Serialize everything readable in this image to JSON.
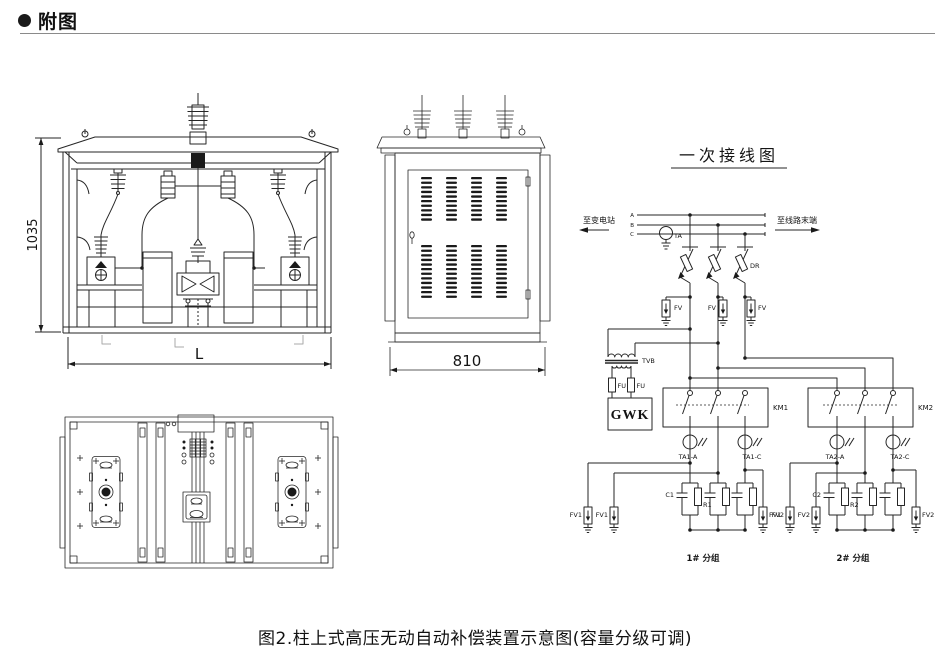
{
  "header": {
    "title": "附图"
  },
  "front_view": {
    "height_dim": "1035",
    "width_dim": "L"
  },
  "side_view": {
    "width_dim": "810"
  },
  "circuit": {
    "title": "一次接线图",
    "to_substation": "至变电站",
    "to_line_end": "至线路末端",
    "phase_a": "A",
    "phase_b": "B",
    "phase_c": "C",
    "ta_label": "TA",
    "dr_label": "DR",
    "fv_label": "FV",
    "tvb_label": "TVB",
    "fu_label": "FU",
    "gwk_label": "GWK",
    "km1_label": "KM1",
    "km2_label": "KM2",
    "ta1a_label": "TA1-A",
    "ta1c_label": "TA1-C",
    "ta2a_label": "TA2-A",
    "ta2c_label": "TA2-C",
    "c1_label": "C1",
    "r1_label": "R1",
    "c2_label": "C2",
    "r2_label": "R2",
    "fv1_label": "FV1",
    "fv2_label": "FV2",
    "group1_label": "1# 分组",
    "group2_label": "2# 分组"
  },
  "caption": "图2.柱上式高压无动自动补偿装置示意图(容量分级可调)"
}
